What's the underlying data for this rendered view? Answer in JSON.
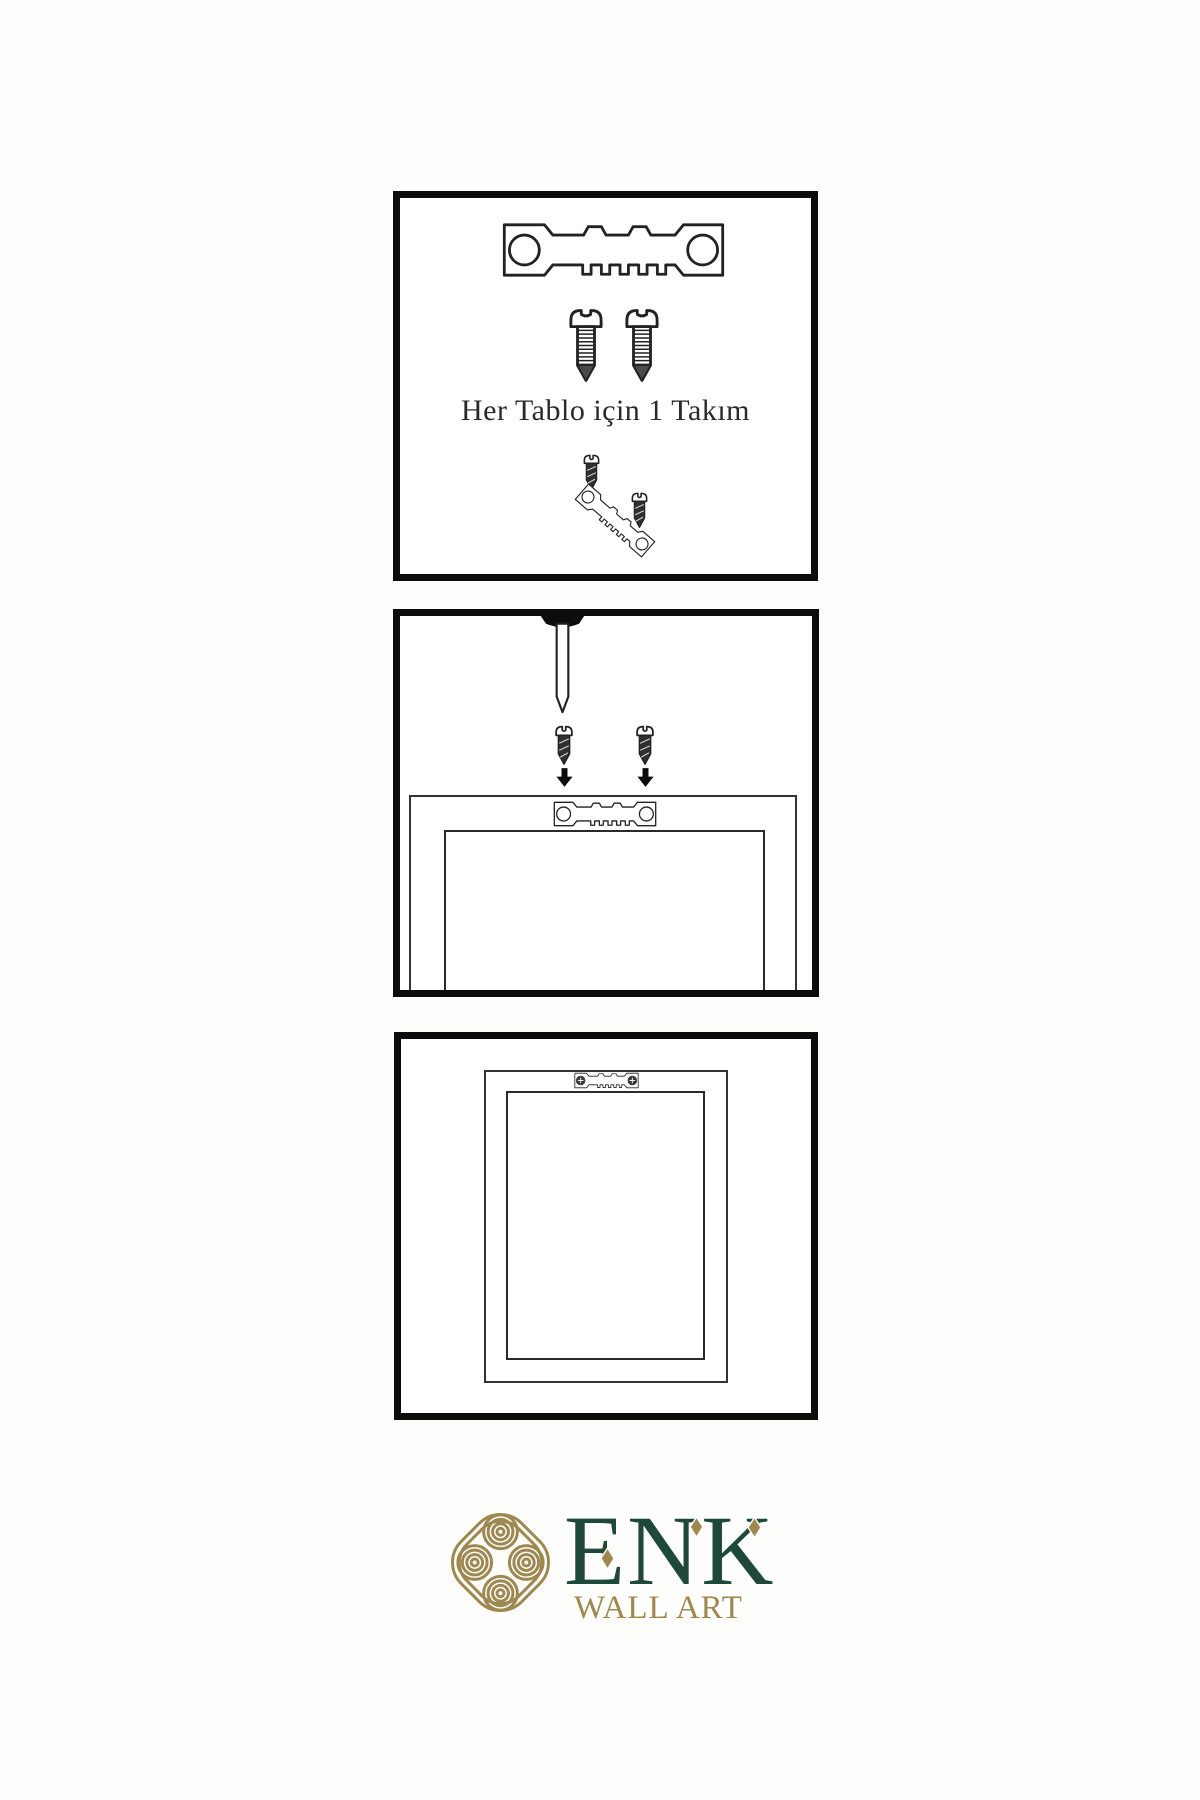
{
  "colors": {
    "bg": "#fdfdfc",
    "border": "#0c0c0c",
    "line": "#222222",
    "dark": "#2f2f2f",
    "green": "#1e4839",
    "gold": "#9e8850",
    "text": "#2a2a2a"
  },
  "step1": {
    "caption": "Her Tablo için 1 Takım"
  },
  "logo": {
    "brand": "ENK",
    "subtitle": "WALL ART"
  },
  "icons": {
    "sawtooth_hanger": "sawtooth-hanger",
    "installed_hanger": "sawtooth-hanger-with-screws",
    "long_screw": "threaded-screw",
    "small_screw": "dark-screw",
    "nail": "wall-nail",
    "arrow_down": "down-arrow",
    "knot": "interlocking-knot",
    "diamond": "gold-diamond"
  }
}
